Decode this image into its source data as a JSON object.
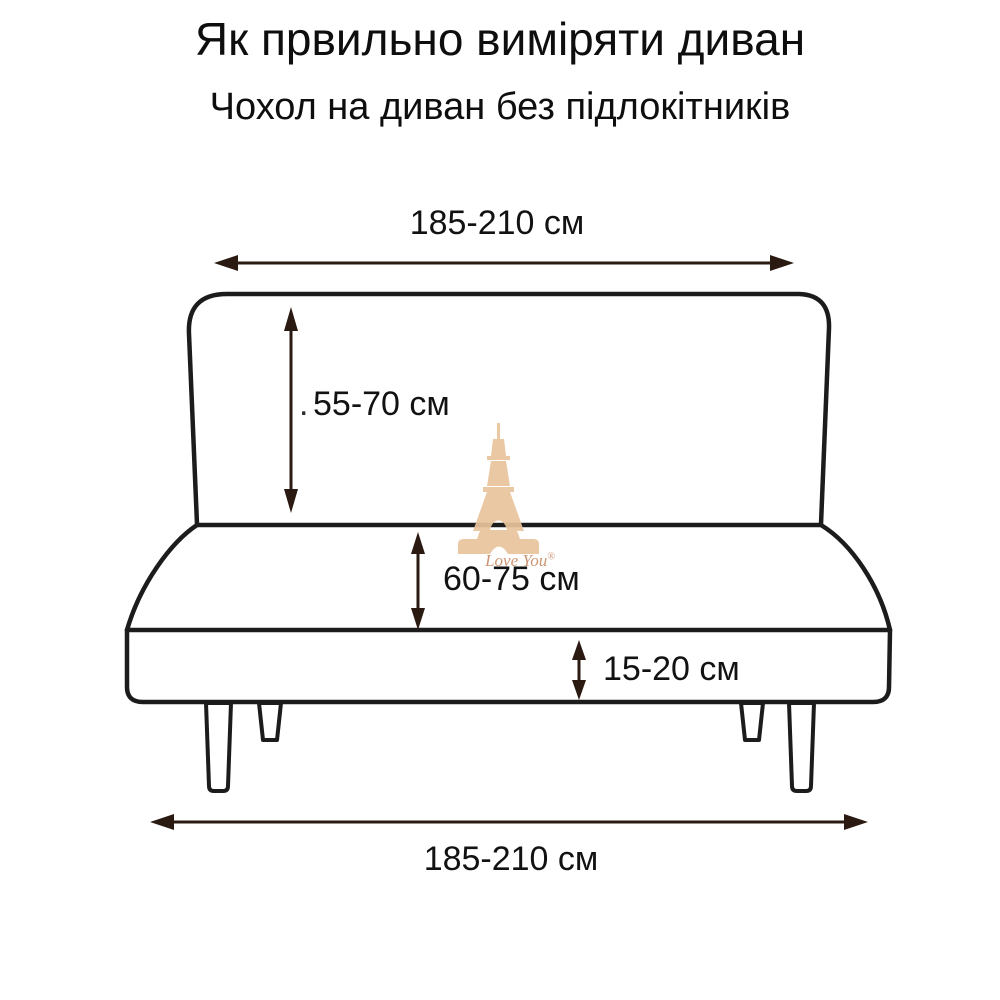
{
  "header": {
    "title": "Як првильно виміряти диван",
    "subtitle": "Чохол на диван без підлокітників"
  },
  "diagram": {
    "type": "sofa-without-armrests-measurement-scheme",
    "measurements": {
      "top_width": "185-210 см",
      "back_height": "55-70 см",
      "seat_height": "60-75 см",
      "base_height": "15-20 см",
      "bottom_width": "185-210 см"
    },
    "stray_dot": "."
  },
  "watermark": {
    "icon": "eiffel-tower-icon",
    "brand": "Love You",
    "registered_mark": "®"
  },
  "colors": {
    "outline": "#1c1c1c",
    "arrow": "#2a1a12",
    "text": "#121212",
    "watermark_tan": "#e8c49c",
    "watermark_text": "#c9906c",
    "background": "#ffffff"
  }
}
